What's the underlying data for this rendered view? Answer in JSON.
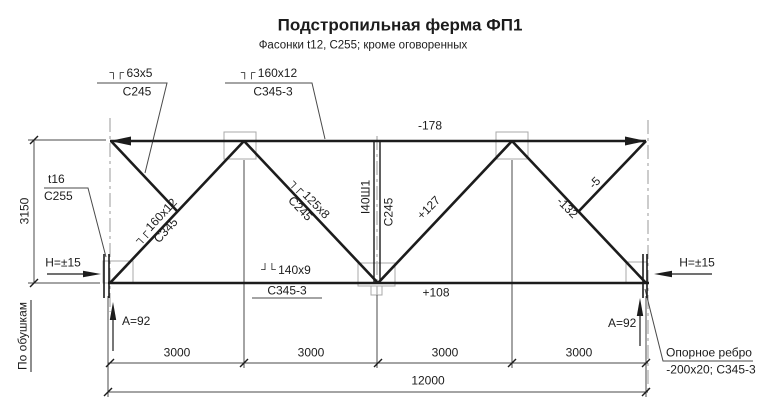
{
  "title": "Подстропильная ферма ФП1",
  "subtitle": "Фасонки t12, С255; кроме оговоренных",
  "callouts": {
    "top_left": {
      "symbol": "┐┌",
      "size": "63x5",
      "steel": "С245"
    },
    "top_mid": {
      "symbol": "┐┌",
      "size": "160x12",
      "steel": "С345-3"
    },
    "bottom_chord": {
      "symbol": "┘└",
      "size": "140x9",
      "steel": "С345-3"
    },
    "gusset": {
      "size": "t16",
      "steel": "С255"
    },
    "bearing_rib": {
      "line1": "Опорное ребро",
      "line2": "-200x20; С345-3"
    }
  },
  "members": {
    "diag_left": {
      "symbol": "┐┌",
      "size": "160x12",
      "steel": "С345"
    },
    "diag_mid": {
      "symbol": "┐┌",
      "size": "125x8",
      "steel": "С245"
    },
    "vertical": {
      "profile": "I40Ш1",
      "steel": "С245"
    }
  },
  "forces": {
    "top_chord": "-178",
    "bottom_chord": "+108",
    "diag_up": "+127",
    "diag_down": "-132",
    "diag_short": "-5"
  },
  "dimensions": {
    "height": "3150",
    "panels": [
      "3000",
      "3000",
      "3000",
      "3000"
    ],
    "total": "12000",
    "note": "По обушкам"
  },
  "supports": {
    "h_left": "H=±15",
    "h_right": "H=±15",
    "a_left": "A=92",
    "a_right": "A=92"
  },
  "colors": {
    "line": "#1c1c1c",
    "thin": "#4a4a4a",
    "aux": "#9a9a9a"
  }
}
